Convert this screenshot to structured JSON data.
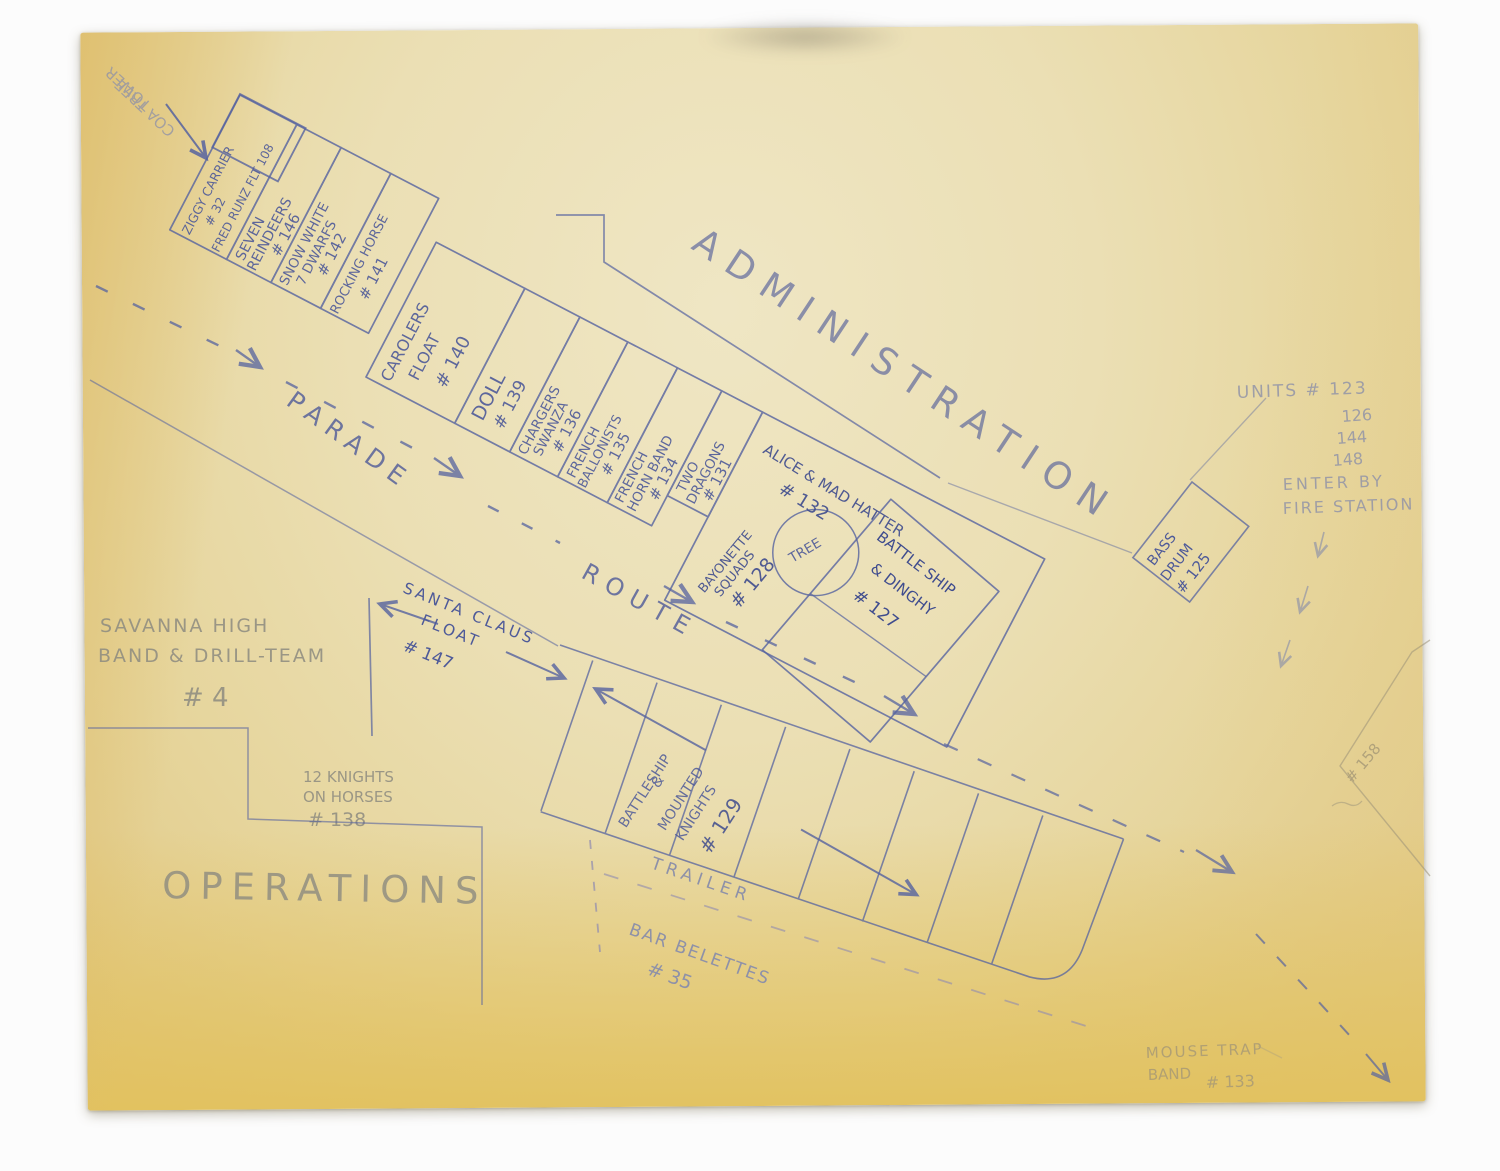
{
  "palette": {
    "ink": "#4e5a99",
    "ink_dark": "#3f4c8e",
    "pencil": "#8d8b80",
    "pencil_blue": "#8e91a8",
    "pencil_warm": "#a59876",
    "paper": "#e8dbab"
  },
  "corner_note": {
    "line1": "COA TREE",
    "line2": "TOWER"
  },
  "admin_label": "ADMINISTRATION",
  "operations_label": "OPERATIONS",
  "parade_label": "PARADE",
  "route_label": "ROUTE",
  "float_row": {
    "box_ziggy": {
      "l1": "ZIGGY CARRIER",
      "l2": "# 32",
      "l3": "FRED RUNZ FLT 108"
    },
    "box_reindeers": {
      "l1": "SEVEN",
      "l2": "REINDEERS",
      "l3": "# 146"
    },
    "box_snow_white": {
      "l1": "SNOW WHITE",
      "l2": "7 DWARFS",
      "l3": "# 142"
    },
    "box_rocking_horse": {
      "l1": "ROCKING HORSE",
      "l2": "# 141"
    },
    "box_carolers": {
      "l1": "CAROLERS",
      "l2": "FLOAT",
      "l3": "# 140"
    },
    "box_doll": {
      "l1": "DOLL",
      "l2": "# 139"
    },
    "box_chargers": {
      "l1": "CHARGERS",
      "l2": "SWANZA",
      "l3": "# 136"
    },
    "box_ballonists": {
      "l1": "FRENCH",
      "l2": "BALLONISTS",
      "l3": "# 135"
    },
    "box_horn_band": {
      "l1": "FRENCH",
      "l2": "HORN BAND",
      "l3": "# 134"
    },
    "box_dragons": {
      "l1": "TWO",
      "l2": "DRAGONS",
      "l3": "# 131"
    },
    "bayonette": {
      "l1": "BAYONETTE",
      "l2": "SQUADS",
      "l3": "# 128"
    },
    "alice": {
      "l1": "ALICE & MAD HATTER",
      "l2": "# 132"
    },
    "tree": "TREE",
    "battleship_dinghy": {
      "l1": "BATTLE SHIP",
      "l2": "& DINGHY",
      "l3": "# 127"
    },
    "bass_drum": {
      "l1": "BASS",
      "l2": "DRUM",
      "l3": "# 125"
    }
  },
  "units_note": {
    "l1": "UNITS # 123",
    "l2": "126",
    "l3": "144",
    "l4": "148",
    "l5": "ENTER BY",
    "l6": "FIRE STATION"
  },
  "savanna_note": {
    "l1": "SAVANNA HIGH",
    "l2": "BAND & DRILL-TEAM",
    "l3": "# 4"
  },
  "knights_note": {
    "l1": "12 KNIGHTS",
    "l2": "ON HORSES",
    "l3": "# 138"
  },
  "santa_float": {
    "l1": "SANTA CLAUS",
    "l2": "FLOAT",
    "l3": "# 147"
  },
  "stall_row": {
    "battleship_knights": {
      "l1": "BATTLESHIP",
      "l2": "&",
      "l3": "MOUNTED",
      "l4": "KNIGHTS",
      "l5": "# 129"
    }
  },
  "trailer_note": {
    "l1": "TRAILER",
    "l2": "BAR BELETTES",
    "l3": "# 35"
  },
  "mousetrap_note": {
    "l1": "MOUSE TRAP",
    "l2": "BAND",
    "l3": "# 133"
  },
  "edge_note": "# 158"
}
